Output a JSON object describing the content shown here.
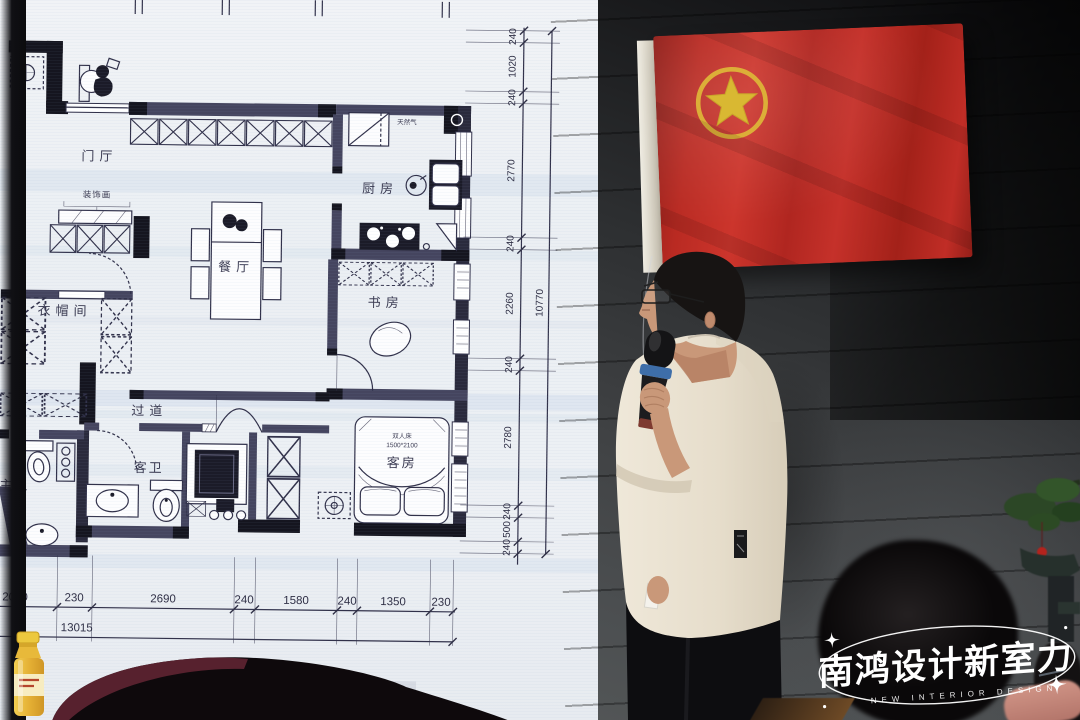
{
  "watermark": {
    "title": "南鸿设计新室力",
    "subtitle": "NEW INTERIOR DESIGN"
  },
  "floor_plan": {
    "caption_visible": "置图",
    "rooms": {
      "entry": "门厅",
      "decor": "装饰画",
      "kitchen": "厨房",
      "dining": "餐厅",
      "study": "书房",
      "cloakroom": "衣帽间",
      "corridor": "过道",
      "guest_bath": "客卫",
      "master_bath": "主卫",
      "guest_room": "客房"
    },
    "kitchen_note": "天然气",
    "bed_note_1": "双人床",
    "bed_note_2": "1500*2100",
    "dims_bottom": [
      "2070",
      "230",
      "2690",
      "240",
      "1580",
      "240",
      "1350",
      "230"
    ],
    "total_bottom": "13015",
    "dims_right": [
      "240",
      "1020",
      "240",
      "2770",
      "240",
      "2260",
      "240",
      "2780",
      "240",
      "500",
      "240"
    ],
    "total_right": "10770"
  },
  "colors": {
    "flag_red": "#b92a22",
    "emblem_yellow": "#d9b832",
    "shirt_cream": "#e8e0d0",
    "screen_white": "#edf0f4",
    "wall_gray": "#3a3d3f"
  }
}
